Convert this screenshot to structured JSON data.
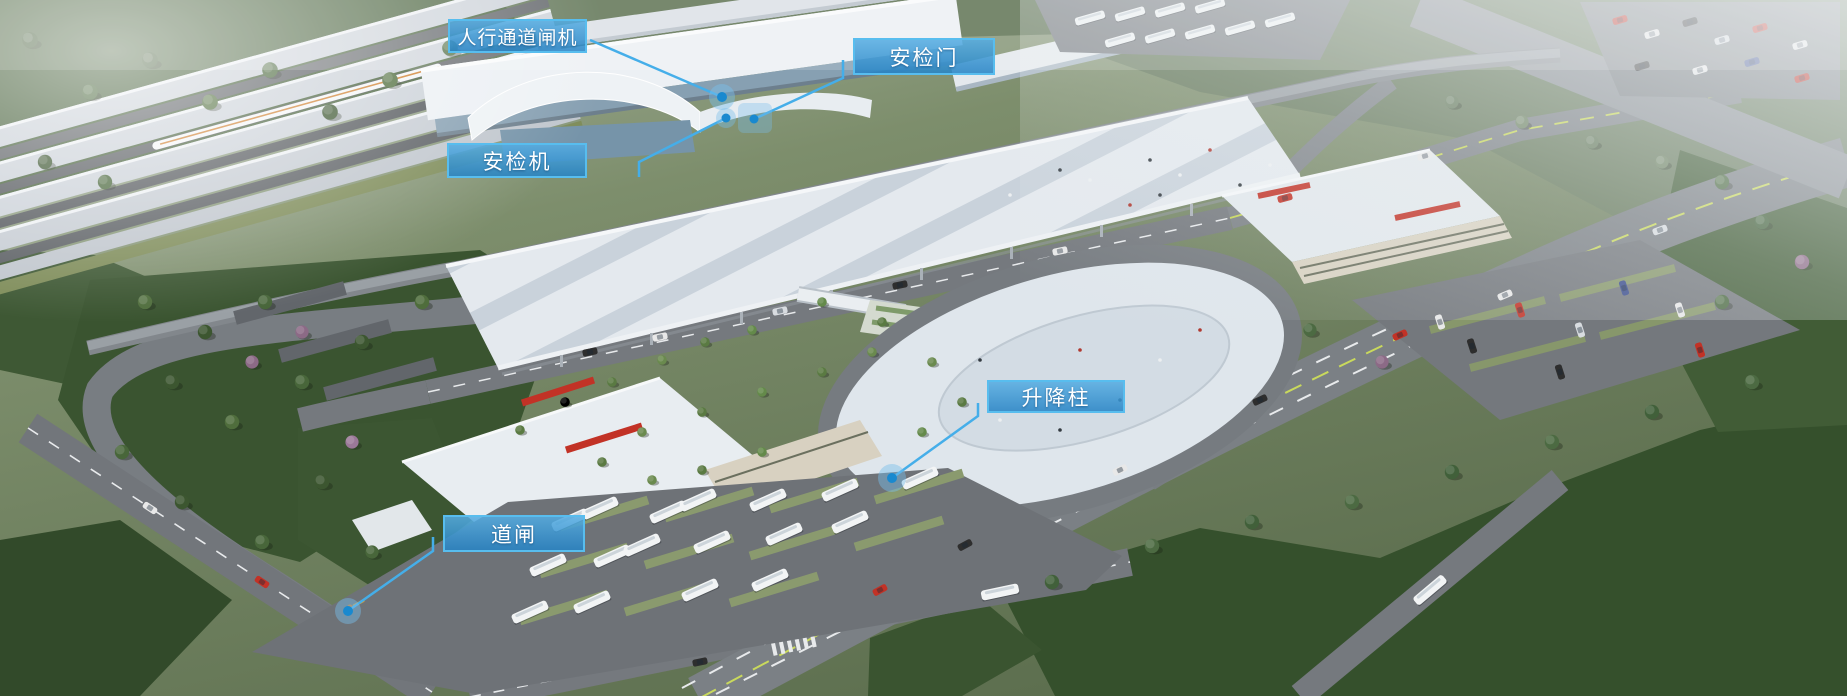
{
  "scene_description": "aerial-render-of-railway-station-smart-access-system",
  "callouts": [
    {
      "id": "pedestrian-gate-machine",
      "label": "人行通道闸机"
    },
    {
      "id": "security-gate",
      "label": "安检门"
    },
    {
      "id": "security-scanner",
      "label": "安检机"
    },
    {
      "id": "lifting-bollard",
      "label": "升降柱"
    },
    {
      "id": "road-barrier",
      "label": "道闸"
    }
  ],
  "colors": {
    "callout_fill": "#3B9BD6",
    "callout_border": "#58BDEE",
    "callout_text": "#FFFFFF",
    "leader_line": "#45AEE9",
    "marker_dot": "#1989CF",
    "marker_halo": "rgba(120,190,235,0.45)"
  }
}
